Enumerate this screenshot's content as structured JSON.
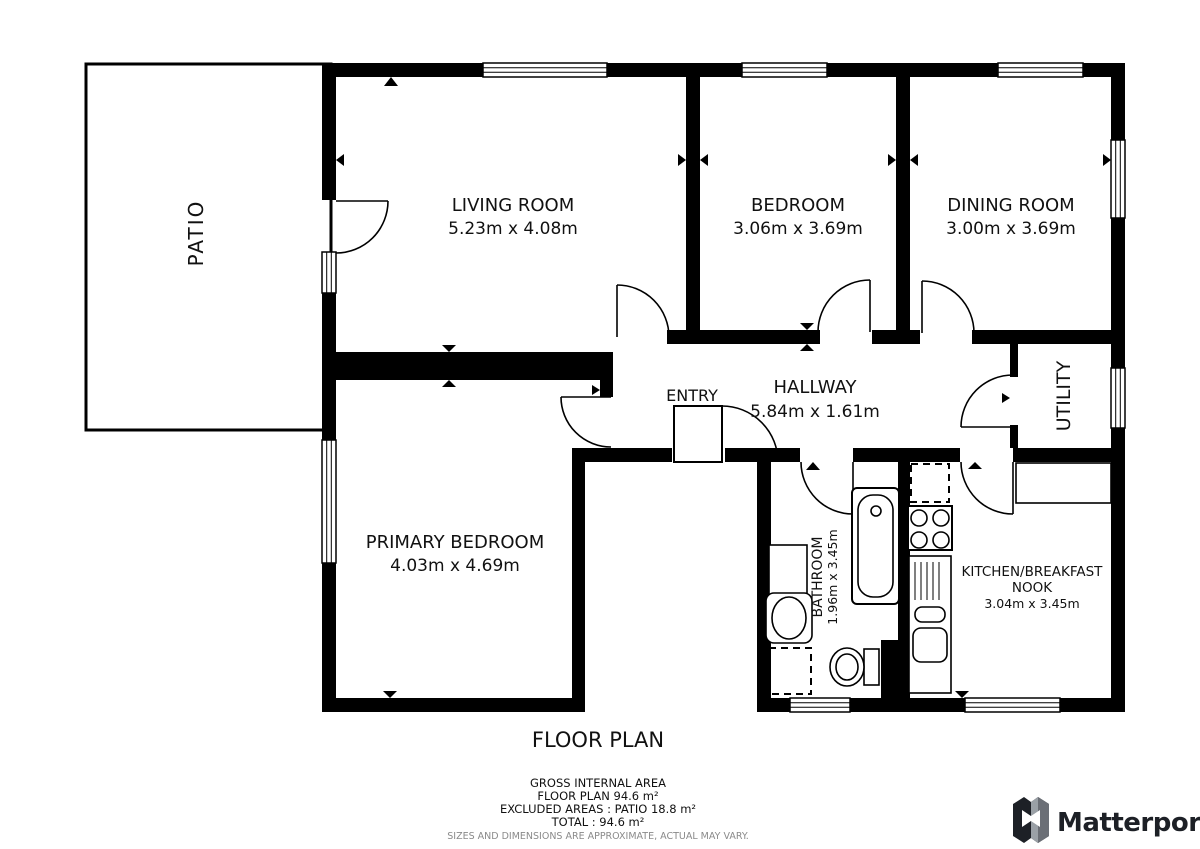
{
  "title": "FLOOR PLAN",
  "rooms": {
    "patio": {
      "name": "PATIO"
    },
    "living_room": {
      "name": "LIVING ROOM",
      "dims": "5.23m x 4.08m"
    },
    "bedroom": {
      "name": "BEDROOM",
      "dims": "3.06m x 3.69m"
    },
    "dining_room": {
      "name": "DINING ROOM",
      "dims": "3.00m x 3.69m"
    },
    "entry": {
      "name": "ENTRY"
    },
    "hallway": {
      "name": "HALLWAY",
      "dims": "5.84m x 1.61m"
    },
    "primary_bedroom": {
      "name": "PRIMARY BEDROOM",
      "dims": "4.03m x 4.69m"
    },
    "utility": {
      "name": "UTILITY"
    },
    "bathroom": {
      "name": "BATHROOM",
      "dims": "1.96m x 3.45m"
    },
    "kitchen": {
      "name_line1": "KITCHEN/BREAKFAST",
      "name_line2": "NOOK",
      "dims": "3.04m x 3.45m"
    }
  },
  "footer": {
    "gross_internal_area": "GROSS INTERNAL AREA",
    "floor_plan_area": "FLOOR PLAN 94.6 m²",
    "excluded_areas": "EXCLUDED AREAS :  PATIO 18.8 m²",
    "total": "TOTAL :  94.6 m²",
    "disclaimer": "SIZES AND DIMENSIONS ARE APPROXIMATE, ACTUAL MAY VARY."
  },
  "branding": {
    "logo_text": "Matterport"
  },
  "colors": {
    "wall": "#000000",
    "background": "#ffffff",
    "disclaimer_gray": "#8a8a8a",
    "logo_dark": "#1d2026"
  }
}
